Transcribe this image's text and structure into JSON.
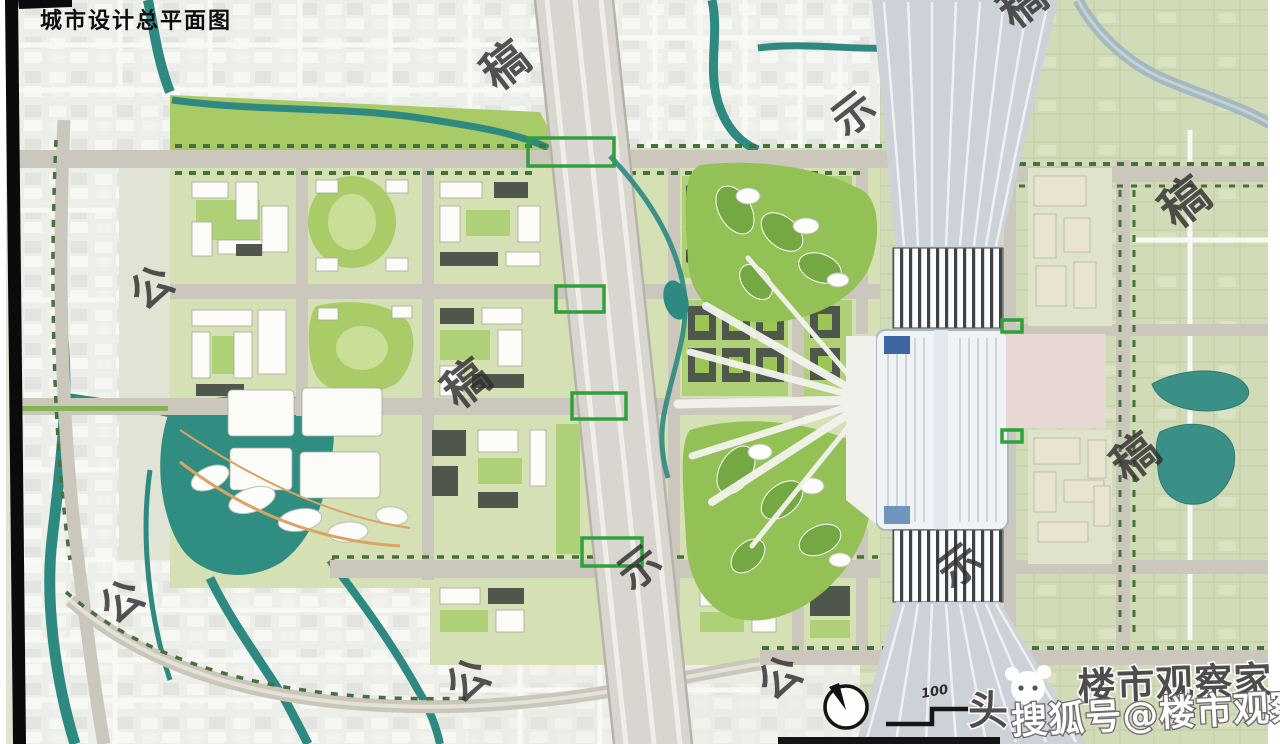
{
  "page": {
    "kind": "urban-design-master-plan-image"
  },
  "title": {
    "label": "城市设计总平面图"
  },
  "map": {
    "watermark": {
      "rotation_deg": -38,
      "color": "#2f2f2f",
      "chars": [
        {
          "char": "稿",
          "x": 497,
          "y": 92,
          "size": 46
        },
        {
          "char": "示",
          "x": 846,
          "y": 138,
          "size": 42
        },
        {
          "char": "稿",
          "x": 1014,
          "y": 30,
          "size": 46
        },
        {
          "char": "稿",
          "x": 1176,
          "y": 230,
          "size": 48
        },
        {
          "char": "公",
          "x": 144,
          "y": 312,
          "size": 42
        },
        {
          "char": "稿",
          "x": 458,
          "y": 410,
          "size": 46
        },
        {
          "char": "稿",
          "x": 1127,
          "y": 484,
          "size": 46
        },
        {
          "char": "示",
          "x": 632,
          "y": 592,
          "size": 42
        },
        {
          "char": "示",
          "x": 952,
          "y": 590,
          "size": 42
        },
        {
          "char": "公",
          "x": 114,
          "y": 626,
          "size": 42
        },
        {
          "char": "公",
          "x": 460,
          "y": 705,
          "size": 42
        },
        {
          "char": "公",
          "x": 772,
          "y": 702,
          "size": 42
        }
      ]
    },
    "scale_bar": {
      "label": "100"
    },
    "north_arrow": {
      "style": "circle-with-needle"
    }
  },
  "branding": {
    "back_left": "头",
    "back_right": "楼市观察家",
    "front": "搜狐号@楼市观察家"
  },
  "palette": {
    "water": "#2e8a80",
    "rural_green": "#d2dbb8",
    "road_gray": "#ccc7bc",
    "park_green": "#9cc653",
    "rail_corridor": "#d9d6cf",
    "station_plaza_pink": "#e7d8d6"
  }
}
